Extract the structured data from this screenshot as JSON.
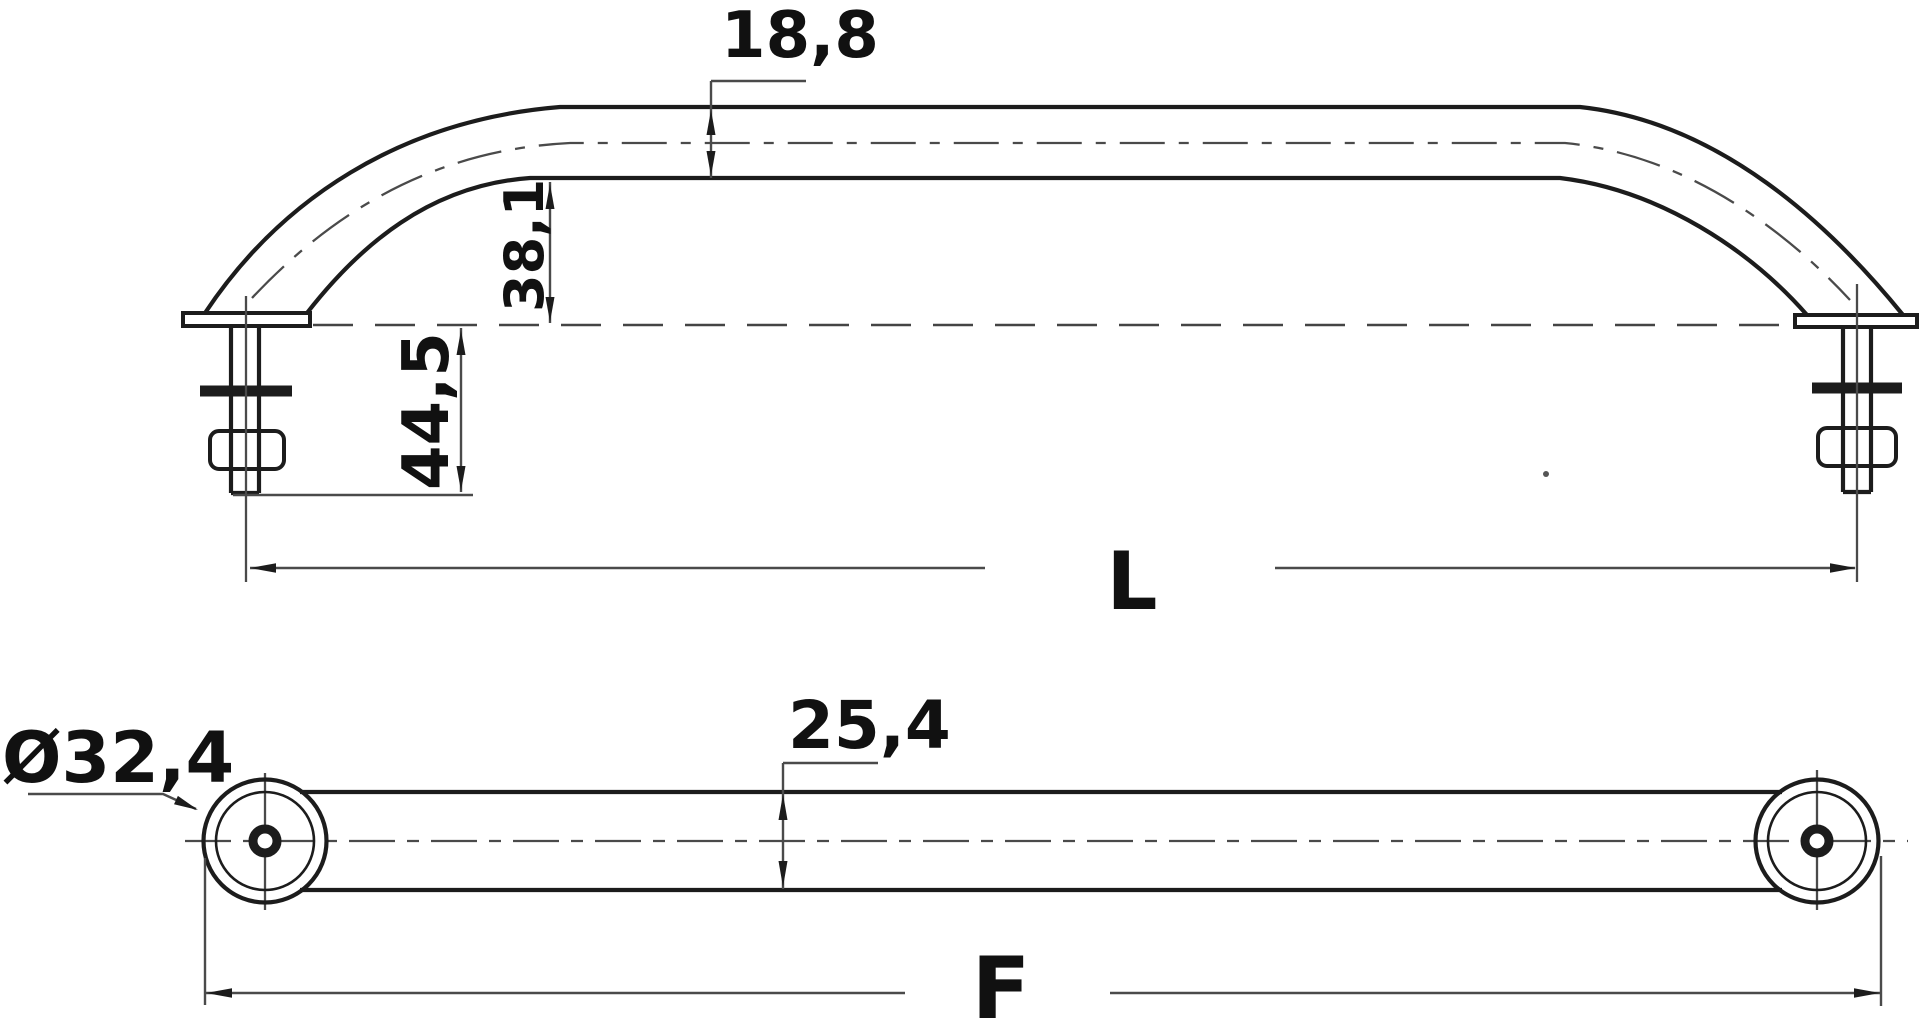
{
  "drawing": {
    "type": "technical-drawing",
    "part": "grab-handrail-with-mounting-studs",
    "colors": {
      "background": "#ffffff",
      "main_line": "#1c1c1c",
      "thin_line": "#4a4a4a",
      "text": "#111111"
    },
    "side_view": {
      "tube_diameter": "18,8",
      "height_under_rail": "38,1",
      "stud_length": "44,5",
      "overall_length": "L"
    },
    "plan_view": {
      "flange_diameter": "Ø32,4",
      "tube_width": "25,4",
      "fixing_length": "F"
    }
  }
}
